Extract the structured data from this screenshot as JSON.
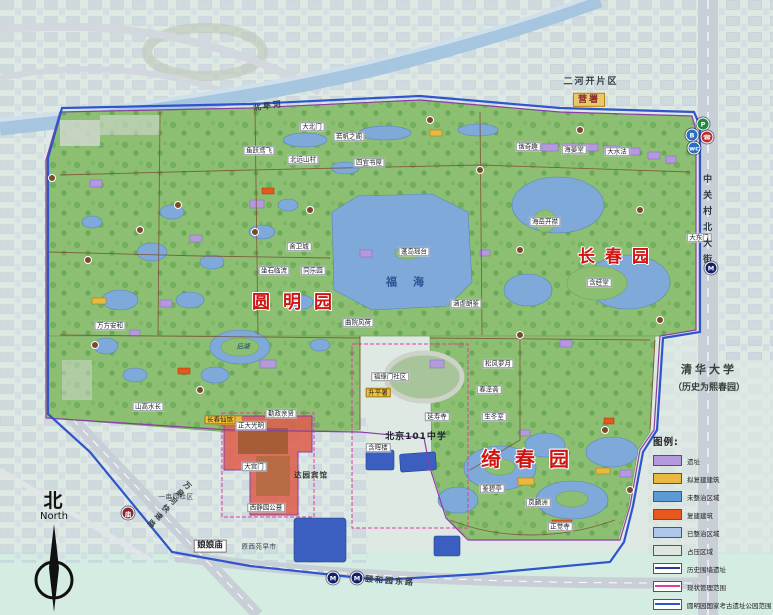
{
  "titles": {
    "yuanmingyuan": "圆明园",
    "changchunyuan": "长春园",
    "qichunyuan": "绮春园"
  },
  "compass": {
    "cn": "北",
    "en": "North"
  },
  "university": {
    "name": "清华大学",
    "note": "（历史为熙春园）"
  },
  "legend": {
    "title": "图例:",
    "items": [
      {
        "label": "遗址",
        "swatch": "fill",
        "color": "#b49add"
      },
      {
        "label": "拟复建建筑",
        "swatch": "fill",
        "color": "#e8b840"
      },
      {
        "label": "未整治区域",
        "swatch": "fill",
        "color": "#5b9bd5"
      },
      {
        "label": "复建建筑",
        "swatch": "fill",
        "color": "#e8571c"
      },
      {
        "label": "已整治区域",
        "swatch": "fill",
        "color": "#aec6ea"
      },
      {
        "label": "占压区域",
        "swatch": "fill",
        "color": "#dfe5df"
      },
      {
        "label": "历史围墙遗址",
        "swatch": "line",
        "color": "#2b3a9c"
      },
      {
        "label": "现状管理范围",
        "swatch": "line",
        "color": "#e23ba0"
      },
      {
        "label": "圆明园国家考古遗址公园范围",
        "swatch": "line",
        "color": "#2f55cc"
      }
    ]
  },
  "colors": {
    "park_green": "#8cbf72",
    "tree_green": "#4f9344",
    "water": "#7ea9d8",
    "deep_water": "#3a5fc0",
    "urban": "#c2cfdd",
    "background": "#dfe9e3",
    "road": "#c9cfd6",
    "boundary_blue": "#2f55cc",
    "wall_purple": "#8a3fa8",
    "management_pink": "#e23ba0",
    "zone_red": "#dd5f4c",
    "title_red": "#cf1512"
  },
  "map": {
    "labels": [
      {
        "t": "大北门",
        "x": 312,
        "y": 127,
        "c": "chip"
      },
      {
        "t": "若帆之阁",
        "x": 349,
        "y": 137,
        "c": "chip"
      },
      {
        "t": "北远山村",
        "x": 303,
        "y": 160,
        "c": "chip"
      },
      {
        "t": "四宜书屋",
        "x": 369,
        "y": 163,
        "c": "chip"
      },
      {
        "t": "鱼跃鸢飞",
        "x": 259,
        "y": 151,
        "c": "chip"
      },
      {
        "t": "舍卫城",
        "x": 299,
        "y": 247,
        "c": "chip"
      },
      {
        "t": "同乐园",
        "x": 313,
        "y": 271,
        "c": "chip"
      },
      {
        "t": "坐石临流",
        "x": 274,
        "y": 271,
        "c": "chip"
      },
      {
        "t": "曲院风荷",
        "x": 358,
        "y": 323,
        "c": "chip"
      },
      {
        "t": "蓬岛瑶台",
        "x": 414,
        "y": 252,
        "c": "chip"
      },
      {
        "t": "涵虚朗鉴",
        "x": 466,
        "y": 304,
        "c": "chip"
      },
      {
        "t": "万方安和",
        "x": 110,
        "y": 326,
        "c": "chip"
      },
      {
        "t": "山高水长",
        "x": 148,
        "y": 407,
        "c": "chip"
      },
      {
        "t": "长春仙馆",
        "x": 220,
        "y": 420,
        "c": "chipY"
      },
      {
        "t": "后湖",
        "x": 243,
        "y": 347,
        "c": "water"
      },
      {
        "t": "福海",
        "x": 413,
        "y": 283,
        "c": "waterBig"
      },
      {
        "t": "海岳开襟",
        "x": 545,
        "y": 222,
        "c": "chip"
      },
      {
        "t": "含经堂",
        "x": 599,
        "y": 283,
        "c": "chip"
      },
      {
        "t": "谐奇趣",
        "x": 528,
        "y": 147,
        "c": "chip"
      },
      {
        "t": "海晏堂",
        "x": 574,
        "y": 150,
        "c": "chip"
      },
      {
        "t": "大水法",
        "x": 617,
        "y": 152,
        "c": "chip"
      },
      {
        "t": "大东门",
        "x": 699,
        "y": 238,
        "c": "chip"
      },
      {
        "t": "松风萝月",
        "x": 498,
        "y": 364,
        "c": "chip"
      },
      {
        "t": "春泽斋",
        "x": 489,
        "y": 390,
        "c": "chip"
      },
      {
        "t": "生冬室",
        "x": 494,
        "y": 417,
        "c": "chip"
      },
      {
        "t": "鉴碧亭",
        "x": 492,
        "y": 489,
        "c": "chip"
      },
      {
        "t": "凤麟洲",
        "x": 538,
        "y": 503,
        "c": "chip"
      },
      {
        "t": "正觉寺",
        "x": 560,
        "y": 527,
        "c": "chip"
      },
      {
        "t": "正大光明",
        "x": 251,
        "y": 426,
        "c": "chip"
      },
      {
        "t": "大宫门",
        "x": 254,
        "y": 467,
        "c": "chip"
      },
      {
        "t": "勤政亲贤",
        "x": 281,
        "y": 414,
        "c": "chip"
      },
      {
        "t": "福缘门社区",
        "x": 390,
        "y": 377,
        "c": "chip"
      },
      {
        "t": "升平署",
        "x": 378,
        "y": 393,
        "c": "chipY"
      },
      {
        "t": "北京101中学",
        "x": 416,
        "y": 437,
        "c": "school"
      },
      {
        "t": "含晖楼",
        "x": 378,
        "y": 448,
        "c": "chip"
      },
      {
        "t": "延寿寺",
        "x": 437,
        "y": 417,
        "c": "chip"
      },
      {
        "t": "达园宾馆",
        "x": 311,
        "y": 476,
        "c": "plain"
      },
      {
        "t": "娘娘庙",
        "x": 210,
        "y": 546,
        "c": "chipBig"
      },
      {
        "t": "西静园公墓",
        "x": 266,
        "y": 508,
        "c": "chip"
      },
      {
        "t": "一亩园社区",
        "x": 176,
        "y": 497,
        "c": "plainS"
      },
      {
        "t": "原西苑早市",
        "x": 259,
        "y": 547,
        "c": "plainS"
      },
      {
        "t": "二河开片区",
        "x": 591,
        "y": 82,
        "c": "district"
      },
      {
        "t": "营署",
        "x": 589,
        "y": 100,
        "c": "chipY2"
      },
      {
        "t": "中关村北大街",
        "x": 706,
        "y": 222,
        "c": "roadV"
      },
      {
        "t": "颐和园东路",
        "x": 390,
        "y": 581,
        "c": "road",
        "r": 4
      },
      {
        "t": "万泉河快速路",
        "x": 168,
        "y": 505,
        "c": "roadV2",
        "r": 43
      },
      {
        "t": "北旱河",
        "x": 268,
        "y": 106,
        "c": "road",
        "r": -8
      }
    ],
    "icons": [
      {
        "k": "parking-icon",
        "g": "P",
        "x": 703,
        "y": 124,
        "bg": "#1f8a3c"
      },
      {
        "k": "bus-icon",
        "g": "B",
        "x": 692,
        "y": 135,
        "bg": "#2a6fc0"
      },
      {
        "k": "phone-icon",
        "g": "☎",
        "x": 707,
        "y": 137,
        "bg": "#c03030"
      },
      {
        "k": "toilet-icon",
        "g": "wc",
        "x": 694,
        "y": 148,
        "bg": "#2a6fc0"
      },
      {
        "k": "metro-icon",
        "g": "M",
        "x": 333,
        "y": 578,
        "bg": "#12206b"
      },
      {
        "k": "metro-icon",
        "g": "M",
        "x": 357,
        "y": 578,
        "bg": "#12206b"
      },
      {
        "k": "metro-icon",
        "g": "M",
        "x": 711,
        "y": 268,
        "bg": "#12206b"
      },
      {
        "k": "temple-icon",
        "g": "庙",
        "x": 128,
        "y": 513,
        "bg": "#8a2430"
      }
    ],
    "poi": [
      [
        52,
        178
      ],
      [
        88,
        260
      ],
      [
        140,
        230
      ],
      [
        178,
        205
      ],
      [
        255,
        232
      ],
      [
        310,
        210
      ],
      [
        480,
        170
      ],
      [
        520,
        250
      ],
      [
        640,
        210
      ],
      [
        660,
        320
      ],
      [
        520,
        335
      ],
      [
        605,
        430
      ],
      [
        630,
        490
      ],
      [
        95,
        345
      ],
      [
        200,
        390
      ],
      [
        430,
        120
      ],
      [
        580,
        130
      ]
    ]
  }
}
